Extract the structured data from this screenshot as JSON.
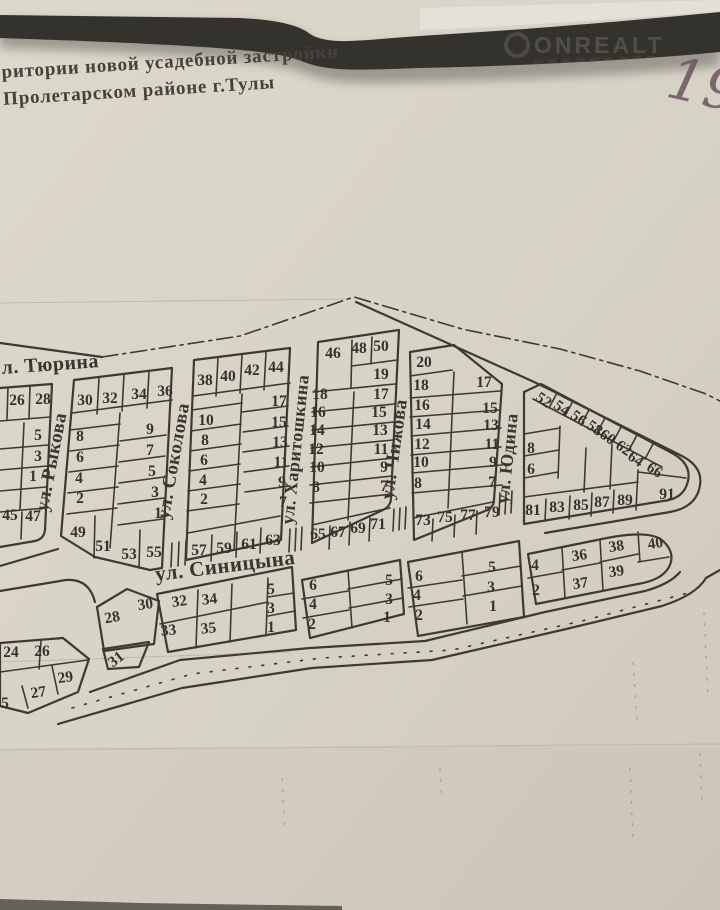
{
  "page": {
    "title_line1": "ритории новой усадебной застройки",
    "title_line2": "Пролетарском районе г.Тулы",
    "watermark": "ONREALT",
    "handwritten_number": "19"
  },
  "map": {
    "street_labels": [
      {
        "text": "л. Тюрина",
        "x": 2,
        "y": 374,
        "size": 20,
        "rot": -4,
        "anchor": "start"
      },
      {
        "text": "ул. Рыкова",
        "x": 57,
        "y": 463,
        "size": 19,
        "rot": -79,
        "anchor": "middle"
      },
      {
        "text": "ул. Соколова",
        "x": 179,
        "y": 462,
        "size": 19,
        "rot": -80,
        "anchor": "middle"
      },
      {
        "text": "ул. Харитошкина",
        "x": 301,
        "y": 450,
        "size": 18,
        "rot": -84,
        "anchor": "middle"
      },
      {
        "text": "ул. Чижова",
        "x": 400,
        "y": 450,
        "size": 19,
        "rot": -82,
        "anchor": "middle"
      },
      {
        "text": "ул. Юдина",
        "x": 513,
        "y": 459,
        "size": 18,
        "rot": -84,
        "anchor": "middle"
      },
      {
        "text": "ул. Синицына",
        "x": 156,
        "y": 581,
        "size": 21,
        "rot": -7,
        "anchor": "start"
      }
    ],
    "plot_labels": [
      {
        "t": "26",
        "x": 17,
        "y": 405
      },
      {
        "t": "28",
        "x": 43,
        "y": 404
      },
      {
        "t": "5",
        "x": 38,
        "y": 440
      },
      {
        "t": "3",
        "x": 38,
        "y": 461
      },
      {
        "t": "1",
        "x": 33,
        "y": 481
      },
      {
        "t": "45",
        "x": 10,
        "y": 520
      },
      {
        "t": "47",
        "x": 33,
        "y": 521
      },
      {
        "t": "30",
        "x": 85,
        "y": 405
      },
      {
        "t": "32",
        "x": 110,
        "y": 403
      },
      {
        "t": "34",
        "x": 139,
        "y": 399
      },
      {
        "t": "36",
        "x": 165,
        "y": 396
      },
      {
        "t": "8",
        "x": 80,
        "y": 441
      },
      {
        "t": "6",
        "x": 80,
        "y": 462
      },
      {
        "t": "4",
        "x": 79,
        "y": 483
      },
      {
        "t": "2",
        "x": 80,
        "y": 503
      },
      {
        "t": "9",
        "x": 150,
        "y": 434
      },
      {
        "t": "7",
        "x": 150,
        "y": 455
      },
      {
        "t": "5",
        "x": 152,
        "y": 476
      },
      {
        "t": "3",
        "x": 155,
        "y": 497
      },
      {
        "t": "1",
        "x": 158,
        "y": 518
      },
      {
        "t": "49",
        "x": 78,
        "y": 537
      },
      {
        "t": "51",
        "x": 103,
        "y": 551
      },
      {
        "t": "53",
        "x": 129,
        "y": 559
      },
      {
        "t": "55",
        "x": 154,
        "y": 557
      },
      {
        "t": "38",
        "x": 205,
        "y": 385
      },
      {
        "t": "40",
        "x": 228,
        "y": 381
      },
      {
        "t": "42",
        "x": 252,
        "y": 375
      },
      {
        "t": "44",
        "x": 276,
        "y": 372
      },
      {
        "t": "10",
        "x": 206,
        "y": 425
      },
      {
        "t": "8",
        "x": 205,
        "y": 445
      },
      {
        "t": "6",
        "x": 204,
        "y": 465
      },
      {
        "t": "4",
        "x": 203,
        "y": 485
      },
      {
        "t": "2",
        "x": 204,
        "y": 504
      },
      {
        "t": "17",
        "x": 279,
        "y": 406
      },
      {
        "t": "15",
        "x": 279,
        "y": 427
      },
      {
        "t": "13",
        "x": 280,
        "y": 447
      },
      {
        "t": "11",
        "x": 281,
        "y": 467
      },
      {
        "t": "9",
        "x": 282,
        "y": 487
      },
      {
        "t": "7",
        "x": 283,
        "y": 507
      },
      {
        "t": "57",
        "x": 199,
        "y": 555
      },
      {
        "t": "59",
        "x": 224,
        "y": 553
      },
      {
        "t": "61",
        "x": 249,
        "y": 549
      },
      {
        "t": "63",
        "x": 273,
        "y": 545
      },
      {
        "t": "46",
        "x": 333,
        "y": 358
      },
      {
        "t": "48",
        "x": 359,
        "y": 353
      },
      {
        "t": "50",
        "x": 381,
        "y": 351
      },
      {
        "t": "19",
        "x": 381,
        "y": 379
      },
      {
        "t": "18",
        "x": 320,
        "y": 399
      },
      {
        "t": "16",
        "x": 318,
        "y": 417
      },
      {
        "t": "14",
        "x": 317,
        "y": 435
      },
      {
        "t": "12",
        "x": 316,
        "y": 454
      },
      {
        "t": "10",
        "x": 317,
        "y": 472
      },
      {
        "t": "8",
        "x": 316,
        "y": 492
      },
      {
        "t": "17",
        "x": 381,
        "y": 399
      },
      {
        "t": "15",
        "x": 379,
        "y": 417
      },
      {
        "t": "13",
        "x": 380,
        "y": 435
      },
      {
        "t": "11",
        "x": 381,
        "y": 454
      },
      {
        "t": "9",
        "x": 384,
        "y": 472
      },
      {
        "t": "7",
        "x": 384,
        "y": 491
      },
      {
        "t": "65",
        "x": 318,
        "y": 539
      },
      {
        "t": "67",
        "x": 338,
        "y": 537
      },
      {
        "t": "69",
        "x": 358,
        "y": 533
      },
      {
        "t": "71",
        "x": 378,
        "y": 529
      },
      {
        "t": "20",
        "x": 424,
        "y": 367
      },
      {
        "t": "18",
        "x": 421,
        "y": 390
      },
      {
        "t": "16",
        "x": 422,
        "y": 410
      },
      {
        "t": "14",
        "x": 423,
        "y": 429
      },
      {
        "t": "12",
        "x": 422,
        "y": 449
      },
      {
        "t": "10",
        "x": 421,
        "y": 467
      },
      {
        "t": "8",
        "x": 418,
        "y": 488
      },
      {
        "t": "17",
        "x": 484,
        "y": 387
      },
      {
        "t": "15",
        "x": 490,
        "y": 413
      },
      {
        "t": "13",
        "x": 491,
        "y": 430
      },
      {
        "t": "11",
        "x": 492,
        "y": 449
      },
      {
        "t": "9",
        "x": 493,
        "y": 467
      },
      {
        "t": "7",
        "x": 492,
        "y": 487
      },
      {
        "t": "73",
        "x": 423,
        "y": 525
      },
      {
        "t": "75",
        "x": 445,
        "y": 522
      },
      {
        "t": "77",
        "x": 468,
        "y": 520
      },
      {
        "t": "79",
        "x": 492,
        "y": 517
      },
      {
        "t": "8",
        "x": 531,
        "y": 453
      },
      {
        "t": "6",
        "x": 531,
        "y": 474
      },
      {
        "t": "52",
        "x": 541,
        "y": 404,
        "rot": 35
      },
      {
        "t": "54",
        "x": 559,
        "y": 412,
        "rot": 35
      },
      {
        "t": "56",
        "x": 576,
        "y": 422,
        "rot": 35
      },
      {
        "t": "58",
        "x": 592,
        "y": 432,
        "rot": 35
      },
      {
        "t": "60",
        "x": 605,
        "y": 441,
        "rot": 35
      },
      {
        "t": "62",
        "x": 621,
        "y": 452,
        "rot": 35
      },
      {
        "t": "64",
        "x": 633,
        "y": 463,
        "rot": 35
      },
      {
        "t": "66",
        "x": 652,
        "y": 474,
        "rot": 33
      },
      {
        "t": "81",
        "x": 533,
        "y": 515
      },
      {
        "t": "83",
        "x": 557,
        "y": 512
      },
      {
        "t": "85",
        "x": 581,
        "y": 510
      },
      {
        "t": "87",
        "x": 602,
        "y": 507
      },
      {
        "t": "89",
        "x": 625,
        "y": 505
      },
      {
        "t": "91",
        "x": 667,
        "y": 499
      },
      {
        "t": "28",
        "x": 113,
        "y": 622,
        "rot": -10
      },
      {
        "t": "31",
        "x": 119,
        "y": 663,
        "rot": -38
      },
      {
        "t": "30",
        "x": 146,
        "y": 609,
        "rot": -8
      },
      {
        "t": "32",
        "x": 180,
        "y": 606,
        "rot": -8
      },
      {
        "t": "34",
        "x": 210,
        "y": 604,
        "rot": -6
      },
      {
        "t": "33",
        "x": 169,
        "y": 635,
        "rot": -6
      },
      {
        "t": "35",
        "x": 209,
        "y": 633,
        "rot": -6
      },
      {
        "t": "5",
        "x": 271,
        "y": 594
      },
      {
        "t": "3",
        "x": 271,
        "y": 613
      },
      {
        "t": "1",
        "x": 271,
        "y": 632
      },
      {
        "t": "6",
        "x": 313,
        "y": 590
      },
      {
        "t": "4",
        "x": 313,
        "y": 609
      },
      {
        "t": "2",
        "x": 312,
        "y": 629
      },
      {
        "t": "5",
        "x": 389,
        "y": 585
      },
      {
        "t": "3",
        "x": 389,
        "y": 604
      },
      {
        "t": "1",
        "x": 387,
        "y": 622
      },
      {
        "t": "6",
        "x": 419,
        "y": 581
      },
      {
        "t": "4",
        "x": 417,
        "y": 600
      },
      {
        "t": "2",
        "x": 419,
        "y": 620
      },
      {
        "t": "5",
        "x": 492,
        "y": 572
      },
      {
        "t": "3",
        "x": 491,
        "y": 592
      },
      {
        "t": "1",
        "x": 493,
        "y": 611
      },
      {
        "t": "4",
        "x": 535,
        "y": 570
      },
      {
        "t": "2",
        "x": 536,
        "y": 595
      },
      {
        "t": "36",
        "x": 580,
        "y": 560,
        "rot": -8
      },
      {
        "t": "37",
        "x": 581,
        "y": 588,
        "rot": -8
      },
      {
        "t": "38",
        "x": 617,
        "y": 551,
        "rot": -8
      },
      {
        "t": "39",
        "x": 617,
        "y": 576,
        "rot": -8
      },
      {
        "t": "40",
        "x": 656,
        "y": 548,
        "rot": -8
      },
      {
        "t": "24",
        "x": 11,
        "y": 657
      },
      {
        "t": "26",
        "x": 42,
        "y": 656
      },
      {
        "t": "29",
        "x": 66,
        "y": 682,
        "rot": -8
      },
      {
        "t": "27",
        "x": 39,
        "y": 697,
        "rot": -8
      },
      {
        "t": "5",
        "x": 5,
        "y": 708
      }
    ]
  }
}
